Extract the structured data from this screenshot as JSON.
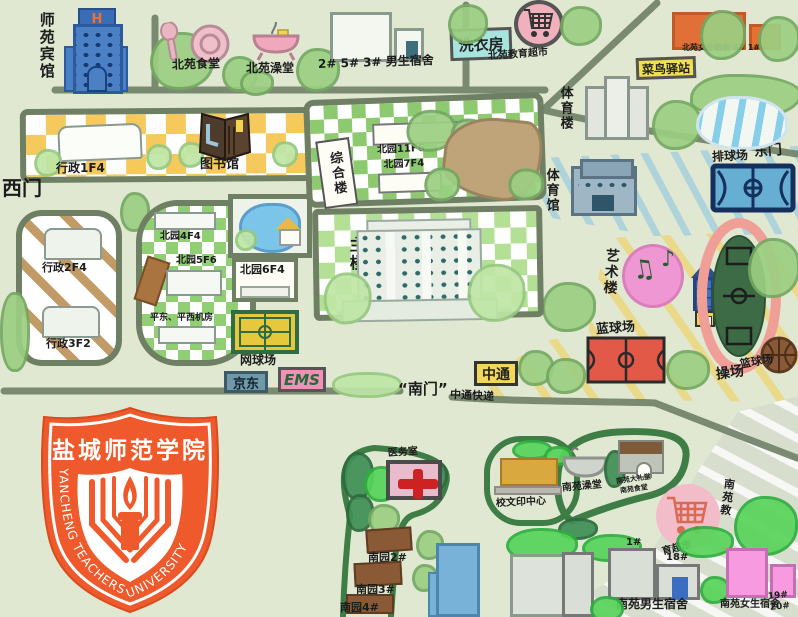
{
  "map_title": "盐城师范学院校园手绘地图",
  "colors": {
    "background": "#e0e8d2",
    "road": "#75856b",
    "logo_orange": "#ee5a2b",
    "admin_block_yellow": "#f6c95c",
    "campus_green": "#86c86e",
    "track_pink": "#f2a39c",
    "court_red": "#e25948",
    "court_blue": "#66aed2",
    "dorm_orange": "#e07038",
    "dorm_pink": "#f79ae0",
    "sign_cyan": "#a8e4de",
    "sign_yellow": "#f2e04e"
  },
  "gates": {
    "west": "西门",
    "east": "东门",
    "south": "“南门”"
  },
  "north": {
    "hotel": "师苑宾馆",
    "hotel_sign": "H",
    "canteen": "北苑食堂",
    "bathhouse": "北苑澡堂",
    "male_dorm": "2# 5# 3# 男生宿舍",
    "laundry": "洗衣房",
    "market": "北苑教育超市",
    "female_dorm": "北苑女生宿舍 4# 1#",
    "cainiao": "菜鸟驿站"
  },
  "west": {
    "admin1": "行政1F4",
    "library": "图书馆",
    "admin2": "行政2F4",
    "admin3": "行政3F2",
    "by4": "北园4F4",
    "by5": "北园5F6",
    "by6": "北园6F4",
    "machine_rooms": "平东、平西机房",
    "tennis": "网球场"
  },
  "center": {
    "complex": "综合楼",
    "by11": "北园11F6",
    "by7": "北园7F4",
    "main": "主楼"
  },
  "east": {
    "sports_building": "体育楼",
    "gym": "体育馆",
    "volleyball": "排球场",
    "art": "艺术楼",
    "blue_court": "蓝球场",
    "track": "操场",
    "basketball": "篮球场"
  },
  "logistics": {
    "jd": "京东",
    "ems": "EMS",
    "zto": "中通",
    "zto_express": "中通快递"
  },
  "south": {
    "clinic": "医务室",
    "ny2": "南园2#",
    "ny3": "南园3#",
    "ny4": "南园4#",
    "print_center": "校文印中心",
    "bathhouse": "南苑澡堂",
    "hall": "南苑大礼堂",
    "canteen": "南苑食堂",
    "market_1": "南苑教",
    "market_2": "育超市",
    "b1": "1#",
    "b18": "18#",
    "male_dorm": "南苑男生宿舍",
    "female_dorm": "南苑女生宿舍",
    "b19": "19#",
    "b20": "20#"
  },
  "logo": {
    "cn": "盐城师范学院",
    "en": "YANCHENG TEACHERS UNIVERSITY"
  },
  "icons": {
    "note1": "♫",
    "note2": "♪"
  }
}
